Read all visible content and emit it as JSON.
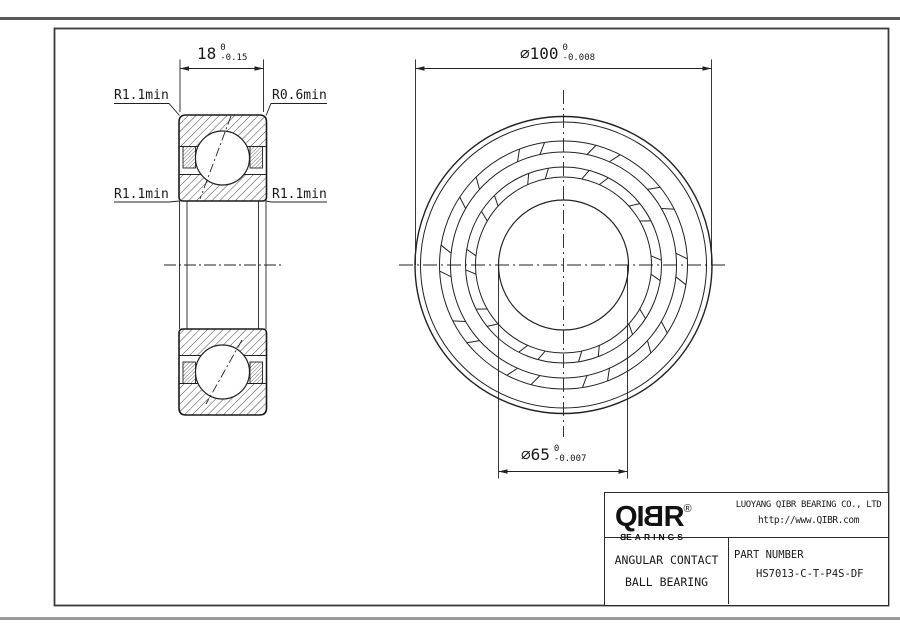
{
  "dimensions": {
    "width": {
      "value": "18",
      "tol_upper": "0",
      "tol_lower": "-0.15"
    },
    "outer_diameter": {
      "symbol": "∅",
      "value": "100",
      "tol_upper": "0",
      "tol_lower": "-0.008"
    },
    "bore_diameter": {
      "symbol": "∅",
      "value": "65",
      "tol_upper": "0",
      "tol_lower": "-0.007"
    }
  },
  "annotations": {
    "radius_top_left": "R1.1min",
    "radius_top_right": "R0.6min",
    "radius_mid_left": "R1.1min",
    "radius_mid_right": "R1.1min"
  },
  "title_block": {
    "logo": {
      "part1": "QI",
      "mirrored_letter": "B",
      "part2": "R",
      "registered": "®",
      "sub_mirrored": "B",
      "sub_rest": "EARINGS"
    },
    "company": "LUOYANG QIBR BEARING CO., LTD",
    "website": "http://www.QIBR.com",
    "product_type_line1": "ANGULAR CONTACT",
    "product_type_line2": "BALL BEARING",
    "part_number_label": "PART NUMBER",
    "part_number": "HS7013-C-T-P4S-DF"
  },
  "colors": {
    "line": "#222222",
    "sheet_edge_top": "#5a5a5a",
    "sheet_edge_bottom": "#9a9a9a"
  }
}
